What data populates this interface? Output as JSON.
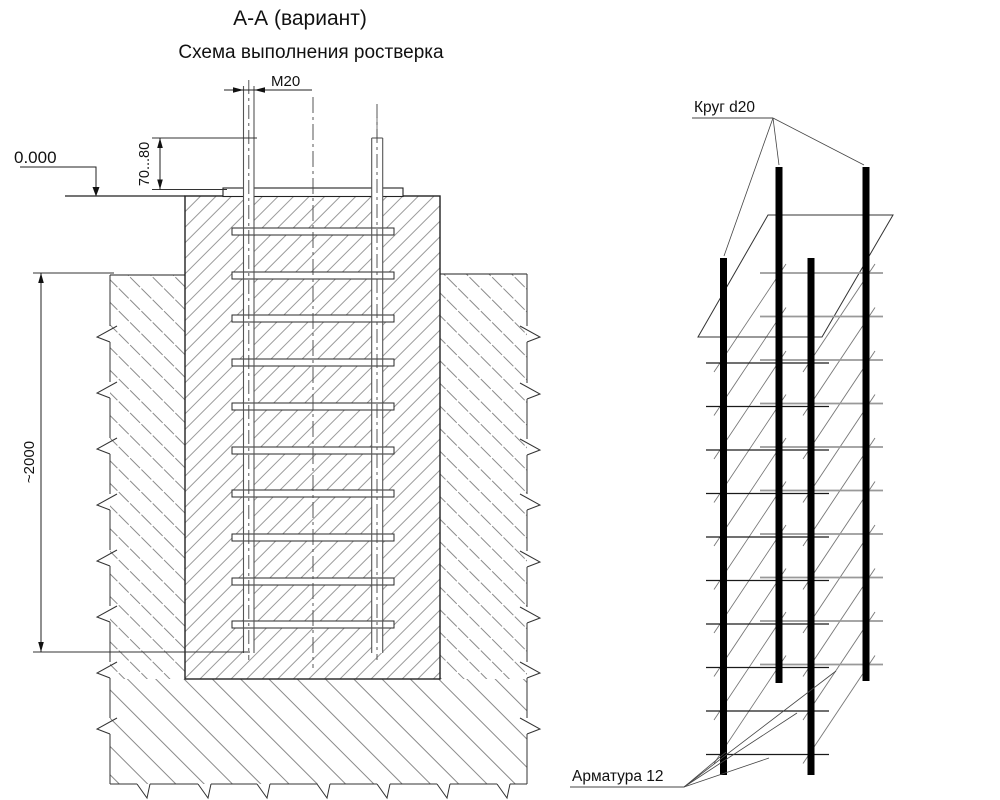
{
  "titles": {
    "section": "А-А (вариант)",
    "scheme": "Схема выполнения ростверка"
  },
  "section_view": {
    "elevation_mark": "0.000",
    "bolt_thread_label": "M20",
    "bolt_protrusion_dim": "70...80",
    "embedment_dim": "~2000",
    "rung_count": 10,
    "anchor_bolt_count": 2
  },
  "cage_view": {
    "rod_label": "Круг d20",
    "rebar_label": "Арматура 12",
    "bolt_count": 4,
    "rung_levels": 10
  },
  "colors": {
    "background": "#ffffff",
    "outline": "#1c1c1c",
    "hatch_concrete": "#999999",
    "hatch_soil": "#8a8a8a",
    "cage_bolt": "#000000",
    "back_rung": "#999999"
  }
}
